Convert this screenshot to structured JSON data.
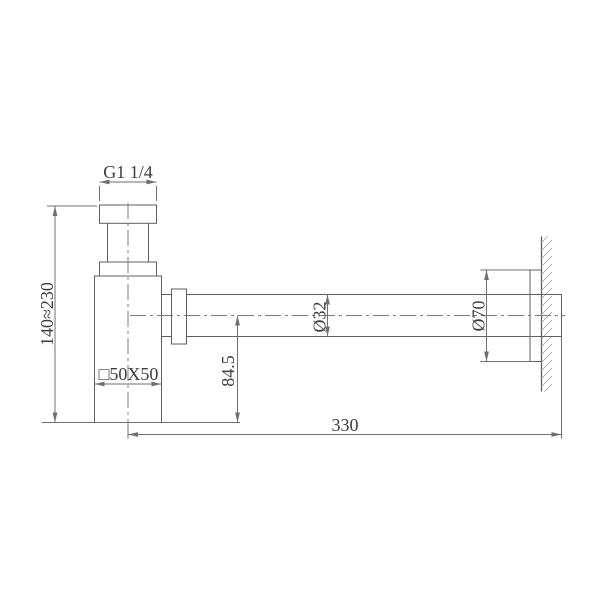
{
  "drawing": {
    "labels": {
      "thread_size": "G1 1/4",
      "height_range": "140≈230",
      "body_section": "□50X50",
      "outlet_drop": "84.5",
      "pipe_diameter": "Ø32",
      "flange_diameter": "Ø70",
      "wall_distance": "330"
    },
    "colors": {
      "object_line": "#5f5f5f",
      "dimension_line": "#6f6f6f",
      "centerline": "#7c7c7c",
      "hatch": "#b4b4b4",
      "text": "#3c3c3c",
      "background": "#ffffff"
    }
  }
}
